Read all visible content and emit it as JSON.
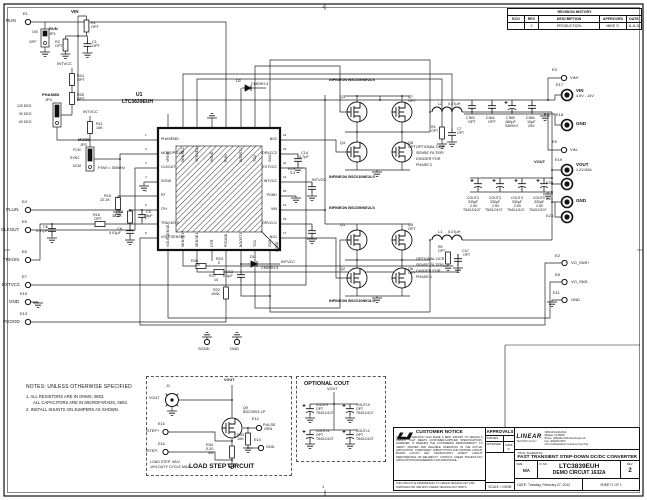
{
  "frame": {
    "zone_top": "1",
    "zone_bottom": "1"
  },
  "revision_history": {
    "title": "REVISION HISTORY",
    "columns": [
      "ECO",
      "REV",
      "DESCRIPTION",
      "APPROVED",
      "DATE"
    ],
    "rows": [
      {
        "eco": "-",
        "rev": "2",
        "description": "PRODUCTION",
        "approved": "MIKE S.",
        "date": "11-8-11"
      }
    ]
  },
  "ic": {
    "ref": "U1",
    "part": "LTC3839EUH",
    "pad": "SGND",
    "pins_left": [
      "PHASEMD",
      "MODE/PLLIN",
      "CLKOUT",
      "SGND",
      "RT",
      "ITH",
      "TRACK/SS",
      "VOUTSENSE+"
    ],
    "pins_right": [
      "BG2",
      "DRVCC2",
      "EXTVCC",
      "INTVCC",
      "PGND",
      "VIN",
      "DRVCC1",
      "BG1"
    ],
    "pins_top": [
      "VRNG",
      "SENSE2-",
      "SENSE2+",
      "SGND",
      "RUN",
      "BOOST2",
      "TG2",
      "SW2"
    ],
    "pins_bottom": [
      "VOUTSENSE-",
      "SENSE1+",
      "SENSE1-",
      "DTR",
      "PGOOD",
      "BOOST1",
      "TG1",
      "SW1"
    ],
    "pin_numbers_left": [
      "1",
      "2",
      "3",
      "4",
      "5",
      "6",
      "7",
      "8"
    ],
    "pin_numbers_right": [
      "24",
      "23",
      "22",
      "21",
      "20",
      "19",
      "18",
      "17"
    ]
  },
  "notes": {
    "heading": "NOTES: UNLESS OTHERWISE SPECIFIED",
    "line1": "1. ALL RESISTORS ARE IN OHMS, 0603.",
    "line2": "ALL CAPACITORS ARE IN MICROFARADS, 0603.",
    "line3": "2. INSTALL SHUNTS ON JUMPERS AS SHOWN."
  },
  "load_step": {
    "title": "LOAD STEP CIRCUIT",
    "caption1": "LOAD STEP: 5A/V",
    "caption2": "10% DUTY CYCLE MAX"
  },
  "optional_cout": {
    "title": "OPTIONAL COUT"
  },
  "title_block": {
    "customer_notice": {
      "title": "CUSTOMER NOTICE",
      "body": "LINEAR TECHNOLOGY HAS MADE A BEST EFFORT TO DESIGN A CIRCUIT THAT MEETS CUSTOMER-SUPPLIED SPECIFICATIONS; HOWEVER, IT REMAINS THE CUSTOMER'S RESPONSIBILITY TO VERIFY PROPER AND RELIABLE OPERATION IN THE ACTUAL APPLICATION. COMPONENT SUBSTITUTION AND PRINTED CIRCUIT BOARD LAYOUT MAY SIGNIFICANTLY AFFECT CIRCUIT PERFORMANCE OR RELIABILITY. CONTACT LINEAR TECHNOLOGY APPLICATIONS ENGINEERING FOR ASSISTANCE.",
      "footer": "THIS CIRCUIT IS PROPRIETARY TO LINEAR TECHNOLOGY AND SUPPLIED FOR USE WITH LINEAR TECHNOLOGY PARTS."
    },
    "approvals": {
      "title": "APPROVALS",
      "rows": [
        {
          "label": "PCB DES.",
          "value": ""
        },
        {
          "label": "APPROVED",
          "value": "MIKE S."
        }
      ],
      "scale": "SCALE = NONE"
    },
    "logo": {
      "company_line1": "LINEAR",
      "company_line2": "TECHNOLOGY",
      "address1": "1630 McCarthy Blvd.",
      "address2": "Milpitas, CA 95035",
      "address3": "Phone: (408)432-1900  www.linear.com",
      "address4": "Fax: (408)434-0507",
      "address5": "LTC Confidential-For Customer Use Only"
    },
    "title_label": "TITLE: SCHEMATIC",
    "title": "FAST TRANSIENT STEP-DOWN DC/DC CONVERTER",
    "size_label": "SIZE",
    "size": "N/A",
    "icno_label": "IC NO.",
    "part": "LTC3839EUH",
    "board": "DEMO CIRCUIT 1632A",
    "rev_label": "REV.",
    "rev": "2",
    "date_label": "DATE:",
    "date": "Tuesday, February 07, 2012",
    "sheet": "SHEET   1   OF   1"
  },
  "schematic_labels": [
    {
      "t": "E1",
      "x": 23,
      "y": 12,
      "s": 4
    },
    {
      "t": "RUN",
      "x": 6,
      "y": 19
    },
    {
      "t": "RUN",
      "x": 49,
      "y": 27,
      "b": 1,
      "s": 4
    },
    {
      "t": "JP1",
      "x": 49,
      "y": 32,
      "s": 4
    },
    {
      "t": "ON",
      "x": 32,
      "y": 31,
      "s": 3.8
    },
    {
      "t": "OFF",
      "x": 29,
      "y": 41,
      "s": 3.8
    },
    {
      "t": "VIN",
      "x": 71,
      "y": 10,
      "b": 1
    },
    {
      "t": "R1",
      "x": 91,
      "y": 22,
      "s": 3.8
    },
    {
      "t": "OPT",
      "x": 91,
      "y": 26,
      "s": 3.8
    },
    {
      "t": "R2",
      "x": 55,
      "y": 41,
      "s": 3.8
    },
    {
      "t": "OPT",
      "x": 55,
      "y": 45,
      "s": 3.8
    },
    {
      "t": "C1",
      "x": 92,
      "y": 41,
      "s": 3.8
    },
    {
      "t": "OPT",
      "x": 92,
      "y": 45,
      "s": 3.8
    },
    {
      "t": "INTVCC",
      "x": 57,
      "y": 62,
      "s": 4
    },
    {
      "t": "R24",
      "x": 77,
      "y": 75,
      "s": 3.8
    },
    {
      "t": "OPT",
      "x": 77,
      "y": 79,
      "s": 3.8
    },
    {
      "t": "R25",
      "x": 77,
      "y": 94,
      "s": 3.8
    },
    {
      "t": "OPT",
      "x": 77,
      "y": 98,
      "s": 3.8
    },
    {
      "t": "PHASMD",
      "x": 42,
      "y": 93,
      "b": 1,
      "s": 4
    },
    {
      "t": "JP4",
      "x": 45,
      "y": 98,
      "s": 4
    },
    {
      "t": "120 DEG",
      "x": 17,
      "y": 105,
      "s": 3.5
    },
    {
      "t": "90 DEG",
      "x": 19,
      "y": 113,
      "s": 3.5
    },
    {
      "t": "60 DEG",
      "x": 19,
      "y": 121,
      "s": 3.5
    },
    {
      "t": "INTVCC",
      "x": 83,
      "y": 110,
      "s": 4
    },
    {
      "t": "R11",
      "x": 96,
      "y": 123,
      "s": 3.8
    },
    {
      "t": "10K",
      "x": 96,
      "y": 127,
      "s": 3.8
    },
    {
      "t": "MODE",
      "x": 78,
      "y": 138,
      "b": 1,
      "s": 4
    },
    {
      "t": "JP2",
      "x": 80,
      "y": 143,
      "s": 4
    },
    {
      "t": "FCM",
      "x": 73,
      "y": 149,
      "s": 3.5
    },
    {
      "t": "SYNC",
      "x": 70,
      "y": 157,
      "s": 3.5
    },
    {
      "t": "DCM",
      "x": 73,
      "y": 165,
      "s": 3.5
    },
    {
      "t": "E4",
      "x": 22,
      "y": 200,
      "s": 4
    },
    {
      "t": "PLLIN",
      "x": 6,
      "y": 208
    },
    {
      "t": "E5",
      "x": 22,
      "y": 220,
      "s": 4
    },
    {
      "t": "CLKOUT",
      "x": 1,
      "y": 228
    },
    {
      "t": "E6",
      "x": 22,
      "y": 250,
      "s": 4
    },
    {
      "t": "TRK/SS",
      "x": 3,
      "y": 258
    },
    {
      "t": "E7",
      "x": 22,
      "y": 275,
      "s": 4
    },
    {
      "t": "EXTVCC",
      "x": 2,
      "y": 283
    },
    {
      "t": "E10",
      "x": 20,
      "y": 292,
      "s": 4
    },
    {
      "t": "GND",
      "x": 9,
      "y": 300
    },
    {
      "t": "E13",
      "x": 20,
      "y": 312,
      "s": 4
    },
    {
      "t": "PGOOD",
      "x": 3,
      "y": 320
    },
    {
      "t": "FSW = 300kHz",
      "x": 98,
      "y": 166,
      "s": 4
    },
    {
      "t": "R15",
      "x": 104,
      "y": 195,
      "s": 3.8
    },
    {
      "t": "22.1K",
      "x": 100,
      "y": 199,
      "s": 3.8
    },
    {
      "t": "R13",
      "x": 116,
      "y": 211,
      "s": 3.8
    },
    {
      "t": "38.3K",
      "x": 112,
      "y": 215,
      "s": 3.8
    },
    {
      "t": "C5",
      "x": 146,
      "y": 211,
      "s": 3.8
    },
    {
      "t": "68pF",
      "x": 144,
      "y": 215,
      "s": 3.8
    },
    {
      "t": "C8",
      "x": 117,
      "y": 228,
      "s": 3.8
    },
    {
      "t": "0.01µF",
      "x": 109,
      "y": 232,
      "s": 3.8
    },
    {
      "t": "R16",
      "x": 93,
      "y": 214,
      "s": 3.8
    },
    {
      "t": "OPT",
      "x": 94,
      "y": 218,
      "s": 3.8
    },
    {
      "t": "C6",
      "x": 43,
      "y": 226,
      "s": 3.8
    },
    {
      "t": "0.47µF",
      "x": 36,
      "y": 230,
      "s": 3.8
    },
    {
      "t": "SGND",
      "x": 276,
      "y": 252,
      "s": 3.5,
      "r": -90
    },
    {
      "t": "R26",
      "x": 191,
      "y": 260,
      "s": 3.8
    },
    {
      "t": "10",
      "x": 196,
      "y": 264,
      "s": 3.8
    },
    {
      "t": "R27",
      "x": 209,
      "y": 275,
      "s": 3.8
    },
    {
      "t": "10",
      "x": 214,
      "y": 279,
      "s": 3.8
    },
    {
      "t": "R23",
      "x": 216,
      "y": 258,
      "s": 3.8
    },
    {
      "t": "0",
      "x": 218,
      "y": 262,
      "s": 3.8
    },
    {
      "t": "C13",
      "x": 226,
      "y": 271,
      "s": 3.8
    },
    {
      "t": "0.1µF",
      "x": 223,
      "y": 275,
      "s": 3.8
    },
    {
      "t": "D1",
      "x": 250,
      "y": 256,
      "s": 3.8
    },
    {
      "t": "CMDSH-3",
      "x": 261,
      "y": 267,
      "s": 3.8
    },
    {
      "t": "INTVCC",
      "x": 281,
      "y": 261,
      "s": 3.8
    },
    {
      "t": "R22",
      "x": 213,
      "y": 289,
      "s": 3.8
    },
    {
      "t": "100K",
      "x": 211,
      "y": 293,
      "s": 3.8
    },
    {
      "t": "D2",
      "x": 236,
      "y": 80,
      "s": 3.8
    },
    {
      "t": "CMDSH-3",
      "x": 251,
      "y": 83,
      "s": 3.8
    },
    {
      "t": "C14",
      "x": 301,
      "y": 152,
      "s": 3.8
    },
    {
      "t": "4.7µF",
      "x": 299,
      "y": 156,
      "s": 3.8
    },
    {
      "t": "R19",
      "x": 288,
      "y": 168,
      "s": 3.8
    },
    {
      "t": "3.3",
      "x": 290,
      "y": 172,
      "s": 3.8
    },
    {
      "t": "INTVCC",
      "x": 312,
      "y": 179,
      "s": 3.8
    },
    {
      "t": "INFINEON BSC050NE2LS",
      "x": 329,
      "y": 79,
      "b": 1,
      "s": 3.8
    },
    {
      "t": "Q3",
      "x": 340,
      "y": 96,
      "s": 3.8
    },
    {
      "t": "Q7",
      "x": 408,
      "y": 96,
      "s": 3.8
    },
    {
      "t": "OPT",
      "x": 408,
      "y": 100,
      "s": 3.8
    },
    {
      "t": "Q4",
      "x": 340,
      "y": 142,
      "s": 3.8
    },
    {
      "t": "Q8",
      "x": 408,
      "y": 142,
      "s": 3.8
    },
    {
      "t": "OPT",
      "x": 408,
      "y": 146,
      "s": 3.8
    },
    {
      "t": "INFINEON BSC010NE2LS",
      "x": 329,
      "y": 176,
      "b": 1,
      "s": 3.8
    },
    {
      "t": "L2",
      "x": 438,
      "y": 103,
      "s": 3.8
    },
    {
      "t": "0.47µH",
      "x": 448,
      "y": 103,
      "s": 3.8
    },
    {
      "t": "OPTIONAL DCR",
      "x": 416,
      "y": 146,
      "s": 3.8
    },
    {
      "t": "SENSE FILTER/",
      "x": 416,
      "y": 152,
      "s": 3.8
    },
    {
      "t": "DIVIDER FOR",
      "x": 416,
      "y": 158,
      "s": 3.8
    },
    {
      "t": "PHASE 2",
      "x": 416,
      "y": 164,
      "s": 3.8
    },
    {
      "t": "R4",
      "x": 431,
      "y": 126,
      "s": 3.5
    },
    {
      "t": "OPT",
      "x": 431,
      "y": 130,
      "s": 3.5
    },
    {
      "t": "C7",
      "x": 457,
      "y": 128,
      "s": 3.5
    },
    {
      "t": "OPT",
      "x": 457,
      "y": 132,
      "s": 3.5
    },
    {
      "t": "INFINEON BSC050NE2LS",
      "x": 329,
      "y": 207,
      "b": 1,
      "s": 3.8
    },
    {
      "t": "Q1",
      "x": 340,
      "y": 224,
      "s": 3.8
    },
    {
      "t": "Q5",
      "x": 408,
      "y": 224,
      "s": 3.8
    },
    {
      "t": "OPT",
      "x": 408,
      "y": 228,
      "s": 3.8
    },
    {
      "t": "Q2",
      "x": 340,
      "y": 268,
      "s": 3.8
    },
    {
      "t": "Q6",
      "x": 408,
      "y": 268,
      "s": 3.8
    },
    {
      "t": "OPT",
      "x": 408,
      "y": 272,
      "s": 3.8
    },
    {
      "t": "INFINEON BSC010NE2LS",
      "x": 329,
      "y": 300,
      "b": 1,
      "s": 3.8
    },
    {
      "t": "L1",
      "x": 438,
      "y": 231,
      "s": 3.8
    },
    {
      "t": "0.47µH",
      "x": 448,
      "y": 231,
      "s": 3.8
    },
    {
      "t": "OPTIONAL DCR",
      "x": 416,
      "y": 258,
      "s": 3.8
    },
    {
      "t": "SENSE FILTER/",
      "x": 416,
      "y": 264,
      "s": 3.8
    },
    {
      "t": "DIVIDER FOR",
      "x": 416,
      "y": 270,
      "s": 3.8
    },
    {
      "t": "PHASE 1",
      "x": 416,
      "y": 276,
      "s": 3.8
    },
    {
      "t": "R5",
      "x": 438,
      "y": 246,
      "s": 3.5
    },
    {
      "t": "OPT",
      "x": 438,
      "y": 250,
      "s": 3.5
    },
    {
      "t": "C10",
      "x": 462,
      "y": 250,
      "s": 3.5
    },
    {
      "t": "OPT",
      "x": 463,
      "y": 254,
      "s": 3.5
    },
    {
      "t": "CIN3",
      "x": 466,
      "y": 117,
      "s": 3.8
    },
    {
      "t": "OPT",
      "x": 468,
      "y": 121,
      "s": 3.8
    },
    {
      "t": "CIN4",
      "x": 486,
      "y": 117,
      "s": 3.8
    },
    {
      "t": "OPT",
      "x": 488,
      "y": 121,
      "s": 3.8
    },
    {
      "t": "CIN5",
      "x": 506,
      "y": 117,
      "s": 3.8
    },
    {
      "t": "180µF",
      "x": 505,
      "y": 121,
      "s": 3.8
    },
    {
      "t": "SANYO",
      "x": 505,
      "y": 125,
      "s": 3.8
    },
    {
      "t": "CIN6",
      "x": 526,
      "y": 117,
      "s": 3.8
    },
    {
      "t": "10µF",
      "x": 527,
      "y": 121,
      "s": 3.8
    },
    {
      "t": "25V",
      "x": 528,
      "y": 125,
      "s": 3.8
    },
    {
      "t": "E3",
      "x": 552,
      "y": 68,
      "s": 4
    },
    {
      "t": "VIN+",
      "x": 570,
      "y": 76,
      "s": 4
    },
    {
      "t": "E17",
      "x": 556,
      "y": 83,
      "s": 4
    },
    {
      "t": "VIN",
      "x": 576,
      "y": 89,
      "b": 1
    },
    {
      "t": "4.5V - 14V",
      "x": 576,
      "y": 95,
      "s": 3.8
    },
    {
      "t": "E18",
      "x": 556,
      "y": 113,
      "s": 4
    },
    {
      "t": "GND",
      "x": 576,
      "y": 122,
      "b": 1
    },
    {
      "t": "E9",
      "x": 552,
      "y": 140,
      "s": 4
    },
    {
      "t": "VIN-",
      "x": 570,
      "y": 148,
      "s": 4
    },
    {
      "t": "VOUT",
      "x": 534,
      "y": 160,
      "b": 1,
      "s": 4
    },
    {
      "t": "E19",
      "x": 555,
      "y": 158,
      "s": 4
    },
    {
      "t": "VOUT",
      "x": 576,
      "y": 163,
      "b": 1
    },
    {
      "t": "1.2V/40A",
      "x": 576,
      "y": 169,
      "s": 3.8
    },
    {
      "t": "E20",
      "x": 546,
      "y": 181,
      "s": 4
    },
    {
      "t": "E21",
      "x": 546,
      "y": 197,
      "s": 4
    },
    {
      "t": "GND",
      "x": 576,
      "y": 199,
      "b": 1
    },
    {
      "t": "E23",
      "x": 546,
      "y": 214,
      "s": 4
    },
    {
      "t": "E2",
      "x": 555,
      "y": 254,
      "s": 4
    },
    {
      "t": "VO_SNS+",
      "x": 571,
      "y": 261,
      "s": 4
    },
    {
      "t": "E8",
      "x": 555,
      "y": 273,
      "s": 4
    },
    {
      "t": "VO_SNS-",
      "x": 571,
      "y": 280,
      "s": 4
    },
    {
      "t": "E11",
      "x": 553,
      "y": 291,
      "s": 4
    },
    {
      "t": "GND",
      "x": 571,
      "y": 298,
      "s": 4
    },
    {
      "t": "COUT2",
      "x": 467,
      "y": 197,
      "s": 3.5
    },
    {
      "t": "330µF",
      "x": 468,
      "y": 201,
      "s": 3.5
    },
    {
      "t": "2.5V",
      "x": 470,
      "y": 205,
      "s": 3.5
    },
    {
      "t": "T543-D107",
      "x": 463,
      "y": 209,
      "s": 3.5
    },
    {
      "t": "COUT3",
      "x": 489,
      "y": 197,
      "s": 3.5
    },
    {
      "t": "330µF",
      "x": 490,
      "y": 201,
      "s": 3.5
    },
    {
      "t": "2.5V",
      "x": 492,
      "y": 205,
      "s": 3.5
    },
    {
      "t": "T543-D107",
      "x": 485,
      "y": 209,
      "s": 3.5
    },
    {
      "t": "COUT4",
      "x": 511,
      "y": 197,
      "s": 3.5
    },
    {
      "t": "330µF",
      "x": 512,
      "y": 201,
      "s": 3.5
    },
    {
      "t": "2.5V",
      "x": 514,
      "y": 205,
      "s": 3.5
    },
    {
      "t": "T543-D107",
      "x": 507,
      "y": 209,
      "s": 3.5
    },
    {
      "t": "COUT5",
      "x": 533,
      "y": 197,
      "s": 3.5
    },
    {
      "t": "330µF",
      "x": 534,
      "y": 201,
      "s": 3.5
    },
    {
      "t": "2.5V",
      "x": 536,
      "y": 205,
      "s": 3.5
    },
    {
      "t": "T543-D107",
      "x": 529,
      "y": 209,
      "s": 3.5
    },
    {
      "t": "SGND",
      "x": 198,
      "y": 347,
      "s": 4
    },
    {
      "t": "GND",
      "x": 230,
      "y": 347,
      "s": 4
    },
    {
      "t": "J1",
      "x": 166,
      "y": 385,
      "s": 3.8
    },
    {
      "t": "VOUT",
      "x": 149,
      "y": 397,
      "s": 3.8
    },
    {
      "t": "VOUT",
      "x": 224,
      "y": 379,
      "b": 1,
      "s": 3.8
    },
    {
      "t": "Q9",
      "x": 243,
      "y": 407,
      "s": 3.8
    },
    {
      "t": "BSC0903-1P",
      "x": 243,
      "y": 411,
      "s": 3.8
    },
    {
      "t": "E12",
      "x": 252,
      "y": 418,
      "s": 3.8
    },
    {
      "t": "PULSE",
      "x": 263,
      "y": 424,
      "s": 3.8
    },
    {
      "t": "GEN",
      "x": 264,
      "y": 428,
      "s": 3.8
    },
    {
      "t": "R33",
      "x": 237,
      "y": 434,
      "s": 3.8
    },
    {
      "t": "10K",
      "x": 237,
      "y": 438,
      "s": 3.8
    },
    {
      "t": "E14",
      "x": 254,
      "y": 439,
      "s": 3.8
    },
    {
      "t": "GND",
      "x": 266,
      "y": 446,
      "s": 3.8
    },
    {
      "t": "R34",
      "x": 206,
      "y": 444,
      "s": 3.8
    },
    {
      "t": "0.20",
      "x": 206,
      "y": 448,
      "s": 3.8
    },
    {
      "t": "3W",
      "x": 208,
      "y": 452,
      "s": 3.8
    },
    {
      "t": "E15",
      "x": 158,
      "y": 423,
      "s": 3.8
    },
    {
      "t": "ISTEP+",
      "x": 146,
      "y": 430,
      "s": 3.8
    },
    {
      "t": "E16",
      "x": 158,
      "y": 443,
      "s": 3.8
    },
    {
      "t": "ISTEP-",
      "x": 146,
      "y": 450,
      "s": 3.8
    },
    {
      "t": "VOUT",
      "x": 327,
      "y": 388,
      "s": 3.8
    },
    {
      "t": "COUT9",
      "x": 316,
      "y": 404,
      "s": 3.5
    },
    {
      "t": "OPT",
      "x": 316,
      "y": 408,
      "s": 3.5
    },
    {
      "t": "T543-D107",
      "x": 316,
      "y": 412,
      "s": 3.5
    },
    {
      "t": "COUT10",
      "x": 356,
      "y": 404,
      "s": 3.5
    },
    {
      "t": "OPT",
      "x": 356,
      "y": 408,
      "s": 3.5
    },
    {
      "t": "T543-D107",
      "x": 356,
      "y": 412,
      "s": 3.5
    },
    {
      "t": "COUT11",
      "x": 316,
      "y": 430,
      "s": 3.5
    },
    {
      "t": "OPT",
      "x": 316,
      "y": 434,
      "s": 3.5
    },
    {
      "t": "T543-D107",
      "x": 316,
      "y": 438,
      "s": 3.5
    },
    {
      "t": "COUT12",
      "x": 356,
      "y": 430,
      "s": 3.5
    },
    {
      "t": "OPT",
      "x": 356,
      "y": 434,
      "s": 3.5
    },
    {
      "t": "T543-D107",
      "x": 356,
      "y": 438,
      "s": 3.5
    }
  ]
}
